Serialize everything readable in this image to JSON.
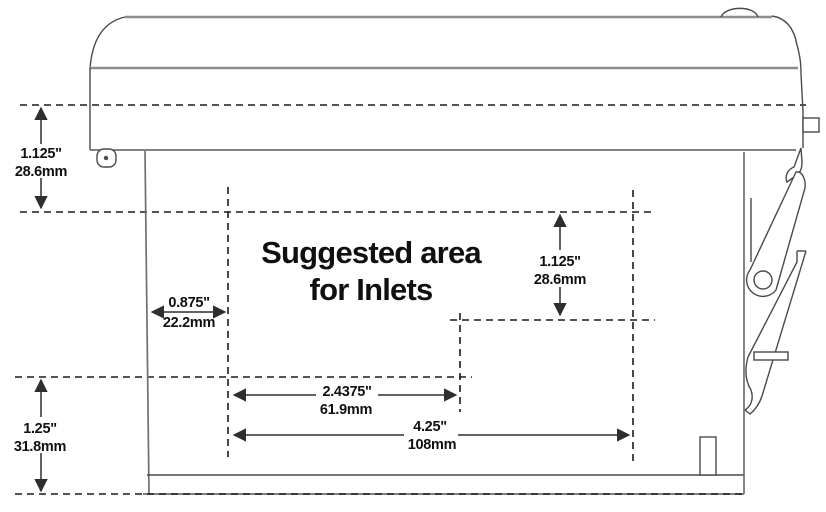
{
  "diagram": {
    "annotation": {
      "line1": "Suggested area",
      "line2": "for Inlets"
    },
    "dimensions": {
      "lid_height": {
        "inches": "1.125\"",
        "mm": "28.6mm"
      },
      "left_inset": {
        "inches": "0.875\"",
        "mm": "22.2mm"
      },
      "base_height": {
        "inches": "1.25\"",
        "mm": "31.8mm"
      },
      "inlet_area_height": {
        "inches": "1.125\"",
        "mm": "28.6mm"
      },
      "inlet_inner_width": {
        "inches": "2.4375\"",
        "mm": "61.9mm"
      },
      "inlet_full_width": {
        "inches": "4.25\"",
        "mm": "108mm"
      }
    },
    "colors": {
      "outline": "#4a4a4a",
      "lid_outline": "#8e8e8e",
      "dashed_guide": "#1c1c1c",
      "dimension_line": "#2e2e2e",
      "text": "#101010",
      "background": "#ffffff"
    }
  }
}
